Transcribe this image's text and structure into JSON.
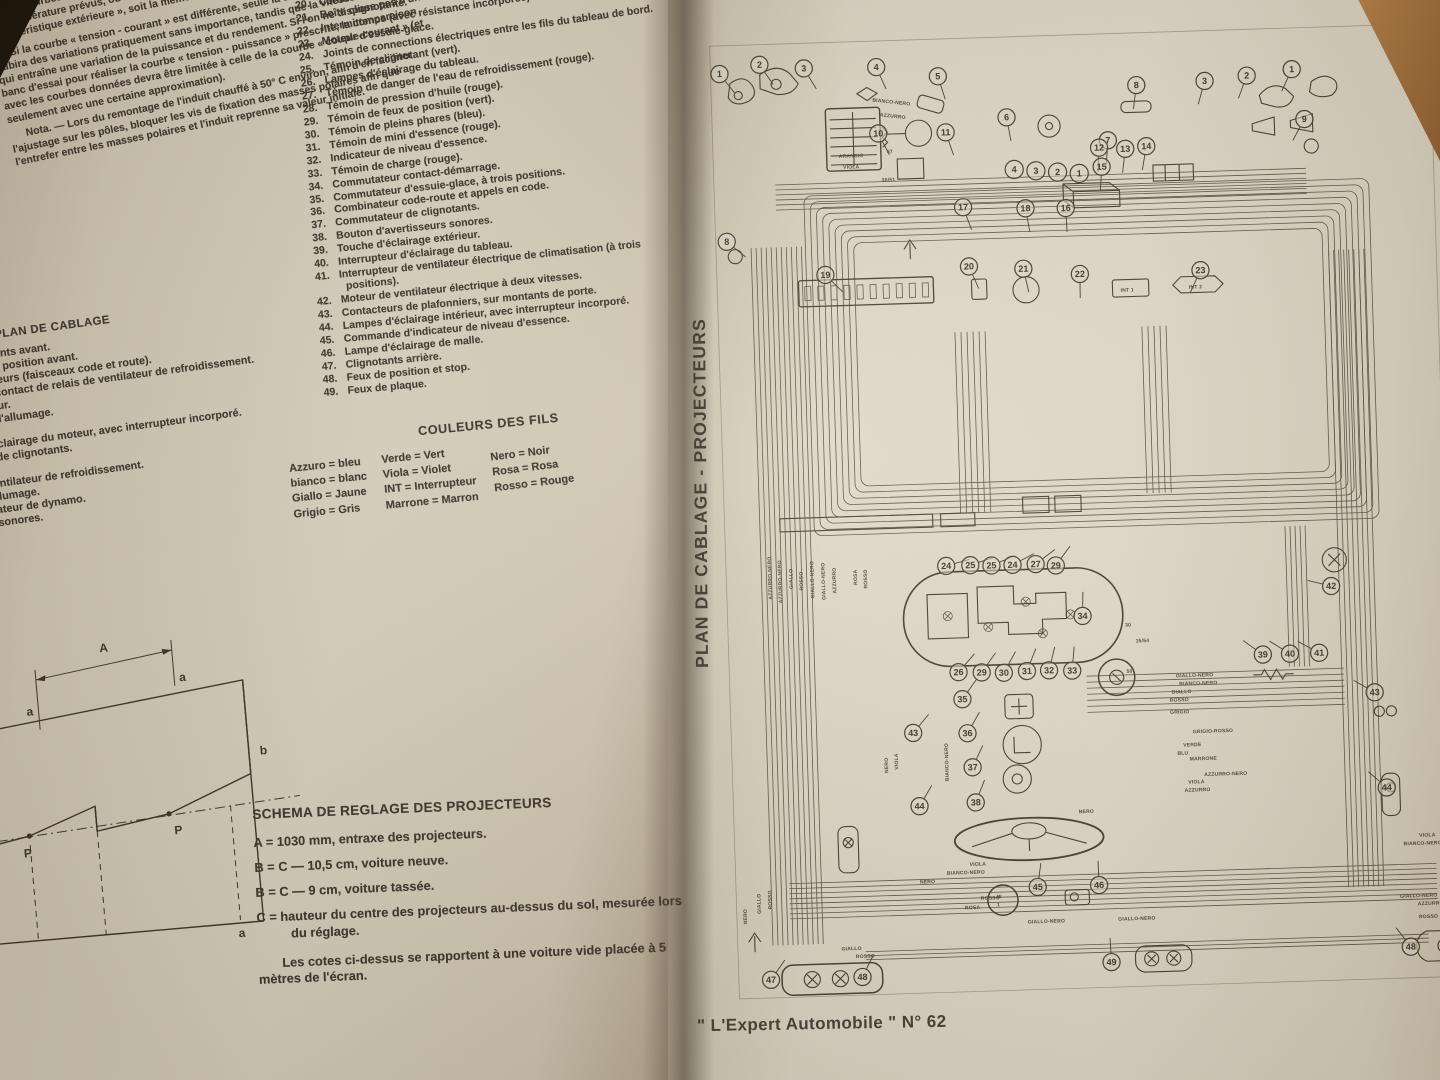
{
  "book": {
    "left_page": {
      "top_text": {
        "intro": [
          "— Un ressort hélicoïdal de pres-",
          "— Un cercle d'arrêt du manchon, qui",
          "coïdal pressé contre ce dernier.",
          "La figure El 11 montre les courbes caractéristiques du démarreur E 84 - 0,8/12."
        ],
        "paragraphs": [
          "Ces courbes sont réalisées avec la batterie d'origine se trouvant à l'état de charge et à la température prévus, ou bien à l'aide d'un autre générateur assurant la même « caractéristique extérieure », soit la même courbe « tension - courant » (fig. El 9).",
          "Si la courbe « tension - courant » est différente, seule la courbe « couple-courant » subira des variations pratiquement sans importance, tandis que la vitesse variera, ce qui entraîne une variation de la puissance et du rendement. Si l'on ne dispose pas d'un banc d'essai pour réaliser la courbe « tension - puissance » prescrite, la comparaison avec les courbes données devra être limitée à celle de la courbe « couple-courant » (et seulement avec une certaine approximation).",
          "Nota. — Lors du remontage de l'induit chauffé à 50° C environ, afin d'en faciliter l'ajustage sur les pôles, bloquer les vis de fixation des masses polaires afin que l'entrefer entre les masses polaires et l'induit reprenne sa valeur initiale."
        ]
      },
      "margin_list": {
        "heading": "PLAN DE CABLAGE",
        "items": [
          {
            "n": "1.",
            "t": "Clignotants avant."
          },
          {
            "n": "2.",
            "t": "Feux de position avant."
          },
          {
            "n": "3.",
            "t": "Projecteurs (faisceaux code et route)."
          },
          {
            "n": "4.",
            "t": "Thermo-contact de relais de ventilateur de refroidissement."
          },
          {
            "n": "5.",
            "t": "Démarreur."
          },
          {
            "n": "6.",
            "t": "Bobine d'allumage."
          },
          {
            "n": "7.",
            "t": "Allumeur."
          },
          {
            "n": "8.",
            "t": "Lampe d'éclairage du moteur, avec interrupteur incorporé."
          },
          {
            "n": "9.",
            "t": "Répétiteurs de clignotants."
          },
          {
            "n": "10.",
            "t": "Batterie."
          },
          {
            "n": "11.",
            "t": "Moteur de ventilateur de refroidissement."
          },
          {
            "n": "12.",
            "t": "Bougies d'allumage."
          },
          {
            "n": "13.",
            "t": "Groupe régulateur de dynamo."
          },
          {
            "n": "14.",
            "t": "Avertisseurs sonores."
          }
        ]
      },
      "numbered_list": {
        "items": [
          {
            "n": "19.",
            "t": ""
          },
          {
            "n": "20.",
            "t": "Contacteur de feux stop (mécanique)."
          },
          {
            "n": "21.",
            "t": "Boîte clignotante."
          },
          {
            "n": "22.",
            "t": "Intermittence (avec résistance incorporée) d'essuie-glace."
          },
          {
            "n": "23.",
            "t": "Moteur d'essuie-glace."
          },
          {
            "n": "24.",
            "t": "Joints de connections électriques entre les fils du tableau de bord."
          },
          {
            "n": "25.",
            "t": "Témoin de clignotant (vert)."
          },
          {
            "n": "26.",
            "t": "Lampes d'éclairage du tableau."
          },
          {
            "n": "27.",
            "t": "Témoin de danger de l'eau de refroidissement (rouge)."
          },
          {
            "n": "28.",
            "t": "Témoin de pression d'huile (rouge)."
          },
          {
            "n": "29.",
            "t": "Témoin de feux de position (vert)."
          },
          {
            "n": "30.",
            "t": "Témoin de pleins phares (bleu)."
          },
          {
            "n": "31.",
            "t": "Témoin de mini d'essence (rouge)."
          },
          {
            "n": "32.",
            "t": "Indicateur de niveau d'essence."
          },
          {
            "n": "33.",
            "t": "Témoin de charge (rouge)."
          },
          {
            "n": "34.",
            "t": "Commutateur contact-démarrage."
          },
          {
            "n": "35.",
            "t": "Commutateur d'essuie-glace, à trois positions."
          },
          {
            "n": "36.",
            "t": "Combinateur code-route et appels en code."
          },
          {
            "n": "37.",
            "t": "Commutateur de clignotants."
          },
          {
            "n": "38.",
            "t": "Bouton d'avertisseurs sonores."
          },
          {
            "n": "39.",
            "t": "Touche d'éclairage extérieur."
          },
          {
            "n": "40.",
            "t": "Interrupteur d'éclairage du tableau."
          },
          {
            "n": "41.",
            "t": "Interrupteur de ventilateur électrique de climatisation (à trois positions)."
          },
          {
            "n": "42.",
            "t": "Moteur de ventilateur électrique à deux vitesses."
          },
          {
            "n": "43.",
            "t": "Contacteurs de plafonniers, sur montants de porte."
          },
          {
            "n": "44.",
            "t": "Lampes d'éclairage intérieur, avec interrupteur incorporé."
          },
          {
            "n": "45.",
            "t": "Commande d'indicateur de niveau d'essence."
          },
          {
            "n": "46.",
            "t": "Lampe d'éclairage de malle."
          },
          {
            "n": "47.",
            "t": "Clignotants arrière."
          },
          {
            "n": "48.",
            "t": "Feux de position et stop."
          },
          {
            "n": "49.",
            "t": "Feux de plaque."
          }
        ]
      },
      "colors_legend": {
        "heading": "COULEURS DES FILS",
        "col1": [
          "Azzuro = bleu",
          "bianco = blanc",
          "Giallo = Jaune",
          "Grigio = Gris"
        ],
        "col2": [
          "Verde = Vert",
          "Viola = Violet",
          "INT = Interrupteur",
          "Marrone = Marron"
        ],
        "col3": [
          "Nero = Noir",
          "Rosa = Rosa",
          "Rosso = Rouge"
        ]
      },
      "aiming_diagram": {
        "labels": {
          "dim": "A",
          "tick_left": "a",
          "tick_right": "a",
          "point_left": "P",
          "point_right": "P",
          "edge_right": "b",
          "bottom": "a"
        }
      },
      "schema": {
        "heading": "SCHEMA DE REGLAGE DES PROJECTEURS",
        "lines": [
          "A = 1030 mm, entraxe des projecteurs.",
          "B = C — 10,5 cm, voiture neuve.",
          "B = C — 9 cm, voiture tassée.",
          "C = hauteur du centre des projecteurs au-dessus du sol, mesurée lors du réglage."
        ],
        "note": "Les cotes ci-dessus se rapportent à une voiture vide placée à 5 mètres de l'écran."
      }
    },
    "right_page": {
      "vertical_title": "PLAN DE CABLAGE - PROJECTEURS",
      "footer": "\" L'Expert Automobile \" N° 62",
      "diagram": {
        "plugs": [
          "4",
          "3",
          "2",
          "1"
        ],
        "callouts": [
          {
            "n": "1",
            "x": 12,
            "y": 38
          },
          {
            "n": "2",
            "x": 52,
            "y": 30
          },
          {
            "n": "3",
            "x": 96,
            "y": 35
          },
          {
            "n": "4",
            "x": 168,
            "y": 36
          },
          {
            "n": "5",
            "x": 229,
            "y": 47
          },
          {
            "n": "8",
            "x": 14,
            "y": 205
          },
          {
            "n": "10",
            "x": 168,
            "y": 102
          },
          {
            "n": "11",
            "x": 235,
            "y": 103
          },
          {
            "n": "6",
            "x": 296,
            "y": 90
          },
          {
            "n": "7",
            "x": 396,
            "y": 116
          },
          {
            "n": "8",
            "x": 426,
            "y": 62
          },
          {
            "n": "3",
            "x": 494,
            "y": 60
          },
          {
            "n": "2",
            "x": 536,
            "y": 56
          },
          {
            "n": "1",
            "x": 581,
            "y": 51
          },
          {
            "n": "9",
            "x": 592,
            "y": 101
          },
          {
            "n": "12",
            "x": 387,
            "y": 123
          },
          {
            "n": "13",
            "x": 413,
            "y": 125
          },
          {
            "n": "14",
            "x": 434,
            "y": 123
          },
          {
            "n": "15",
            "x": 389,
            "y": 142
          },
          {
            "n": "16",
            "x": 352,
            "y": 182
          },
          {
            "n": "17",
            "x": 250,
            "y": 178
          },
          {
            "n": "18",
            "x": 312,
            "y": 181
          },
          {
            "n": "19",
            "x": 111,
            "y": 241
          },
          {
            "n": "20",
            "x": 254,
            "y": 237
          },
          {
            "n": "21",
            "x": 308,
            "y": 241
          },
          {
            "n": "22",
            "x": 364,
            "y": 248
          },
          {
            "n": "23",
            "x": 484,
            "y": 248
          },
          {
            "n": "24",
            "x": 222,
            "y": 534
          },
          {
            "n": "25",
            "x": 246,
            "y": 534
          },
          {
            "n": "25",
            "x": 267,
            "y": 535
          },
          {
            "n": "24",
            "x": 288,
            "y": 535
          },
          {
            "n": "27",
            "x": 311,
            "y": 535
          },
          {
            "n": "29",
            "x": 331,
            "y": 537
          },
          {
            "n": "26",
            "x": 231,
            "y": 640
          },
          {
            "n": "29",
            "x": 254,
            "y": 641
          },
          {
            "n": "30",
            "x": 276,
            "y": 642
          },
          {
            "n": "31",
            "x": 299,
            "y": 641
          },
          {
            "n": "32",
            "x": 321,
            "y": 641
          },
          {
            "n": "33",
            "x": 344,
            "y": 642
          },
          {
            "n": "34",
            "x": 356,
            "y": 588
          },
          {
            "n": "35",
            "x": 234,
            "y": 667
          },
          {
            "n": "36",
            "x": 238,
            "y": 701
          },
          {
            "n": "37",
            "x": 242,
            "y": 735
          },
          {
            "n": "38",
            "x": 244,
            "y": 770
          },
          {
            "n": "43",
            "x": 184,
            "y": 699
          },
          {
            "n": "44",
            "x": 188,
            "y": 772
          },
          {
            "n": "39",
            "x": 534,
            "y": 632
          },
          {
            "n": "40",
            "x": 561,
            "y": 632
          },
          {
            "n": "41",
            "x": 590,
            "y": 632
          },
          {
            "n": "42",
            "x": 604,
            "y": 566
          },
          {
            "n": "43",
            "x": 644,
            "y": 673
          },
          {
            "n": "44",
            "x": 653,
            "y": 768
          },
          {
            "n": "45",
            "x": 303,
            "y": 856
          },
          {
            "n": "46",
            "x": 364,
            "y": 856
          },
          {
            "n": "47",
            "x": 35,
            "y": 940
          },
          {
            "n": "48",
            "x": 126,
            "y": 940
          },
          {
            "n": "49",
            "x": 374,
            "y": 933
          },
          {
            "n": "48",
            "x": 672,
            "y": 927
          }
        ],
        "wire_labels": [
          {
            "t": "BIANCO-NERO",
            "x": 163,
            "y": 70,
            "r": 8
          },
          {
            "t": "AZZURRO",
            "x": 170,
            "y": 85,
            "r": 8
          },
          {
            "t": "ARANCIO",
            "x": 128,
            "y": 125
          },
          {
            "t": "VIOLA",
            "x": 132,
            "y": 136
          },
          {
            "t": "87",
            "x": 176,
            "y": 122
          },
          {
            "t": "30/51",
            "x": 170,
            "y": 150
          },
          {
            "t": "AZZURRO-NERO",
            "x": 48,
            "y": 562,
            "r": -90
          },
          {
            "t": "AZZURRO-NERO",
            "x": 58,
            "y": 566,
            "r": -90
          },
          {
            "t": "GIALLO",
            "x": 69,
            "y": 552,
            "r": -90
          },
          {
            "t": "ROSSO",
            "x": 79,
            "y": 554,
            "r": -90
          },
          {
            "t": "GIALLO-NERO",
            "x": 90,
            "y": 562,
            "r": -90
          },
          {
            "t": "GIALLO-NERO",
            "x": 101,
            "y": 564,
            "r": -90
          },
          {
            "t": "AZZURRO",
            "x": 112,
            "y": 558,
            "r": -90
          },
          {
            "t": "ROSA",
            "x": 133,
            "y": 550,
            "r": -90
          },
          {
            "t": "ROSSO",
            "x": 143,
            "y": 554,
            "r": -90
          },
          {
            "t": "NERO",
            "x": 158,
            "y": 738,
            "r": -90
          },
          {
            "t": "VIOLA",
            "x": 168,
            "y": 735,
            "r": -90
          },
          {
            "t": "BIANCO-NERO",
            "x": 218,
            "y": 748,
            "r": -90
          },
          {
            "t": "GIALLO-NERO",
            "x": 447,
            "y": 652
          },
          {
            "t": "BIANCO-NERO",
            "x": 450,
            "y": 660
          },
          {
            "t": "GIALLO",
            "x": 442,
            "y": 668
          },
          {
            "t": "ROSSO",
            "x": 440,
            "y": 676
          },
          {
            "t": "GRIGIO",
            "x": 440,
            "y": 688
          },
          {
            "t": "GRIGIO-ROSSO",
            "x": 462,
            "y": 708
          },
          {
            "t": "VERDE",
            "x": 452,
            "y": 721
          },
          {
            "t": "BLU",
            "x": 446,
            "y": 729
          },
          {
            "t": "MARRONE",
            "x": 458,
            "y": 735
          },
          {
            "t": "AZZURRO-NERO",
            "x": 472,
            "y": 751
          },
          {
            "t": "VIOLA",
            "x": 456,
            "y": 758
          },
          {
            "t": "AZZURRO",
            "x": 452,
            "y": 766
          },
          {
            "t": "NERO",
            "x": 346,
            "y": 784
          },
          {
            "t": "30",
            "x": 398,
            "y": 600
          },
          {
            "t": "15/54",
            "x": 408,
            "y": 616
          },
          {
            "t": "50",
            "x": 398,
            "y": 646
          },
          {
            "t": "INT 1",
            "x": 404,
            "y": 267
          },
          {
            "t": "INT 2",
            "x": 472,
            "y": 266
          },
          {
            "t": "W",
            "x": 262,
            "y": 866
          },
          {
            "t": "1",
            "x": 262,
            "y": 874
          },
          {
            "t": "VIOLA",
            "x": 236,
            "y": 833
          },
          {
            "t": "BIANCO-NERO",
            "x": 213,
            "y": 841
          },
          {
            "t": "NERO",
            "x": 186,
            "y": 849
          },
          {
            "t": "ROSSO",
            "x": 246,
            "y": 867
          },
          {
            "t": "ROSA",
            "x": 230,
            "y": 876
          },
          {
            "t": "GIALLO-NERO",
            "x": 292,
            "y": 892
          },
          {
            "t": "GIALLO-NERO",
            "x": 382,
            "y": 892
          },
          {
            "t": "GIALLO",
            "x": 106,
            "y": 913
          },
          {
            "t": "ROSSO",
            "x": 120,
            "y": 921
          },
          {
            "t": "NERO",
            "x": 13,
            "y": 884,
            "r": -90
          },
          {
            "t": "GIALLO",
            "x": 27,
            "y": 874,
            "r": -90
          },
          {
            "t": "ROSSO",
            "x": 38,
            "y": 870,
            "r": -90
          },
          {
            "t": "VIOLA",
            "x": 700,
            "y": 818,
            "a": "end"
          },
          {
            "t": "BIANCO-NERO",
            "x": 706,
            "y": 826,
            "a": "end"
          },
          {
            "t": "GIALLO-NERO",
            "x": 700,
            "y": 878,
            "a": "end"
          },
          {
            "t": "AZZURRO",
            "x": 706,
            "y": 886,
            "a": "end"
          },
          {
            "t": "ROSSO",
            "x": 700,
            "y": 899,
            "a": "end"
          }
        ]
      }
    }
  }
}
